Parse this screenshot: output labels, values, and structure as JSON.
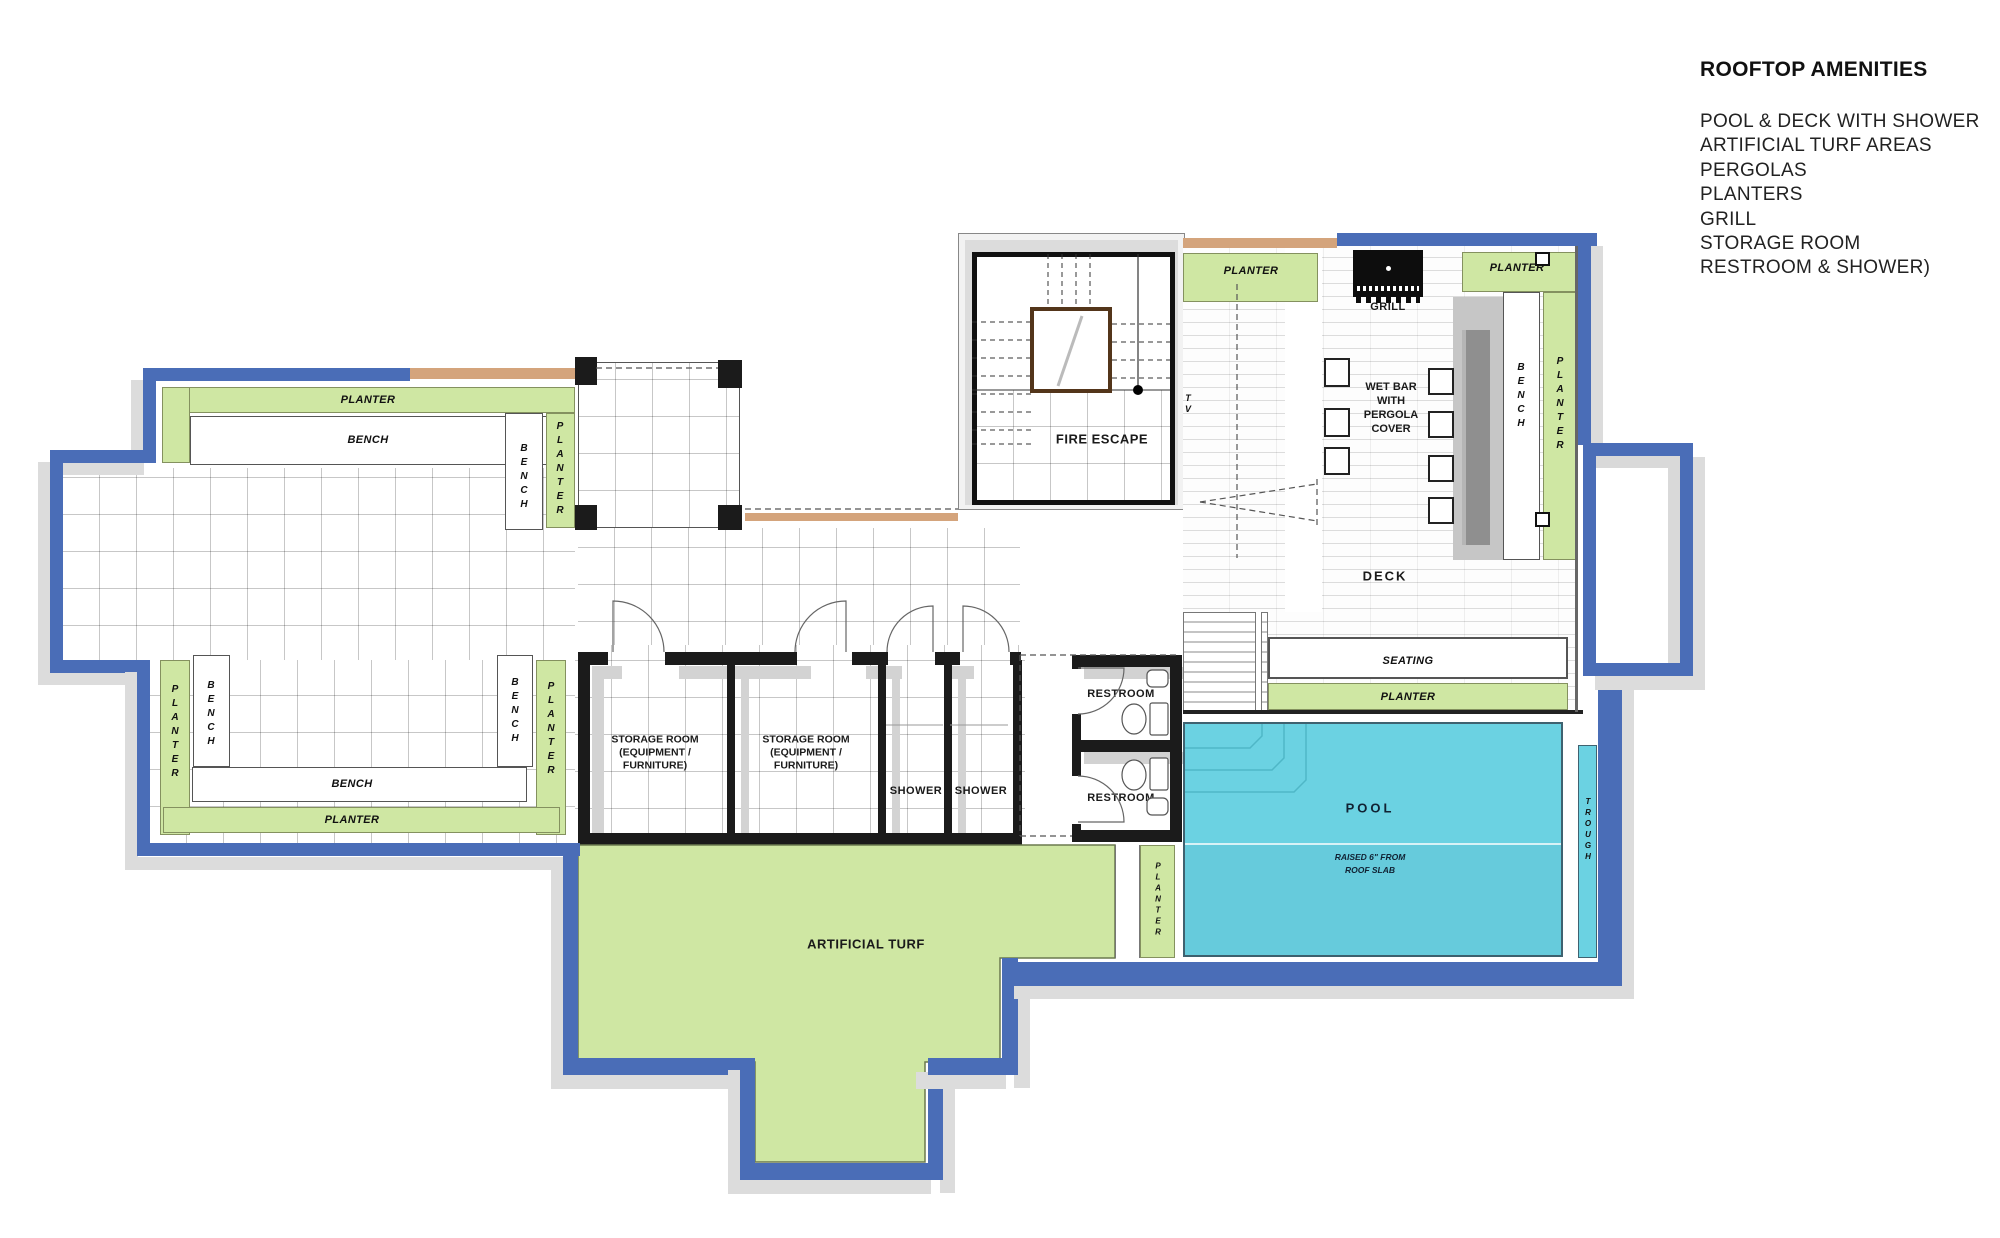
{
  "legend": {
    "title": "ROOFTOP AMENITIES",
    "items": [
      "POOL & DECK WITH SHOWER",
      "ARTIFICIAL TURF AREAS",
      "PERGOLAS",
      "PLANTERS",
      "GRILL",
      "STORAGE ROOM",
      "RESTROOM & SHOWER)"
    ]
  },
  "labels": {
    "planter": "PLANTER",
    "bench": "BENCH",
    "fire_escape": "FIRE ESCAPE",
    "tv": "TV",
    "grill": "GRILL",
    "deck": "DECK",
    "seating": "SEATING",
    "pool": "POOL",
    "trough": "TROUGH",
    "shower": "SHOWER",
    "restroom": "RESTROOM",
    "artificial_turf": "ARTIFICIAL TURF",
    "wet_bar_lines": [
      "WET BAR",
      "WITH",
      "PERGOLA",
      "COVER"
    ],
    "storage_lines": [
      "STORAGE ROOM",
      "(EQUIPMENT /",
      "FURNITURE)"
    ],
    "pool_note_lines": [
      "RAISED 6\" FROM",
      "ROOF SLAB"
    ]
  },
  "colors": {
    "border_blue": "#4a6db7",
    "planter_green": "#cfe7a3",
    "pool_cyan": "#6bd2e2",
    "tan_wood": "#d4a47c",
    "wall_black": "#1b1b1b",
    "shadow_gray": "#dcdcdc"
  }
}
